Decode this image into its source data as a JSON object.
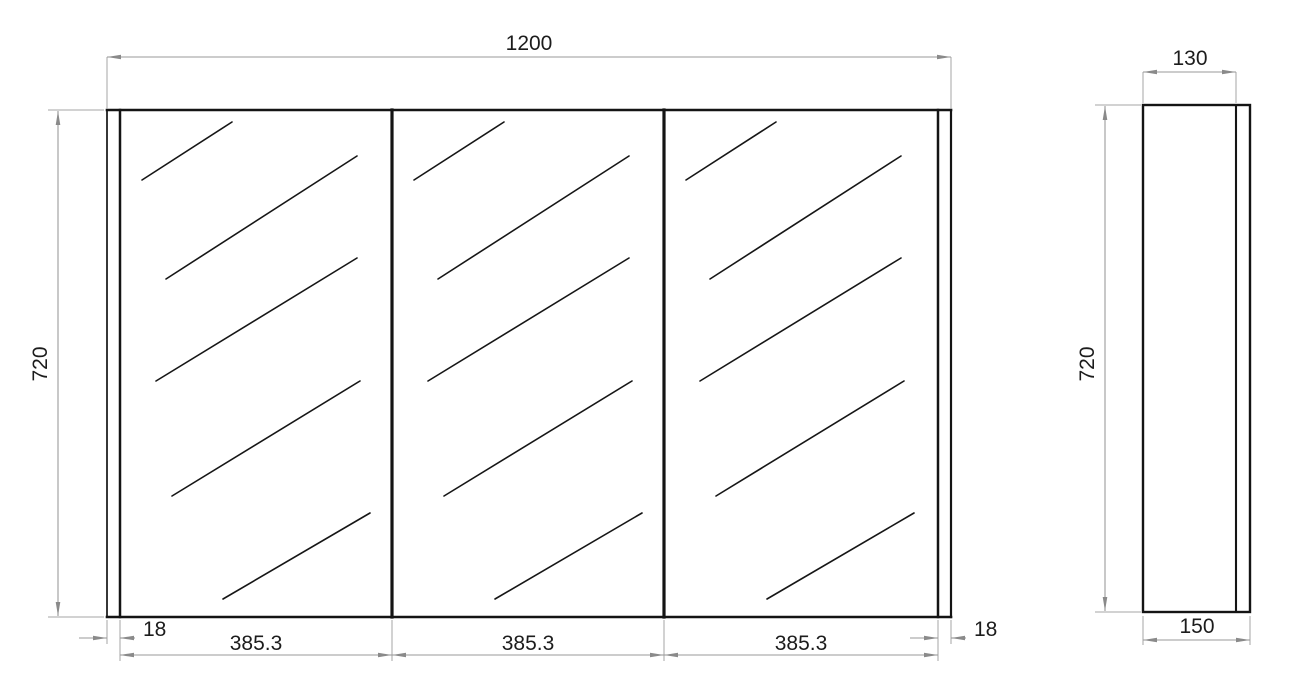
{
  "drawing": {
    "type": "technical-dimension-drawing",
    "subject": "three-door mirror cabinet - front and side elevation",
    "units": "mm",
    "colors": {
      "outline": "#141414",
      "dimension_lines": "#9a9a9a",
      "dimension_text": "#1c1c1c",
      "background": "#ffffff"
    },
    "front_view": {
      "overall_width": "1200",
      "overall_height": "720",
      "left_end_panel": "18",
      "right_end_panel": "18",
      "door_widths": [
        "385.3",
        "385.3",
        "385.3"
      ]
    },
    "side_view": {
      "body_depth": "130",
      "overall_height": "720",
      "overall_depth": "150"
    }
  }
}
